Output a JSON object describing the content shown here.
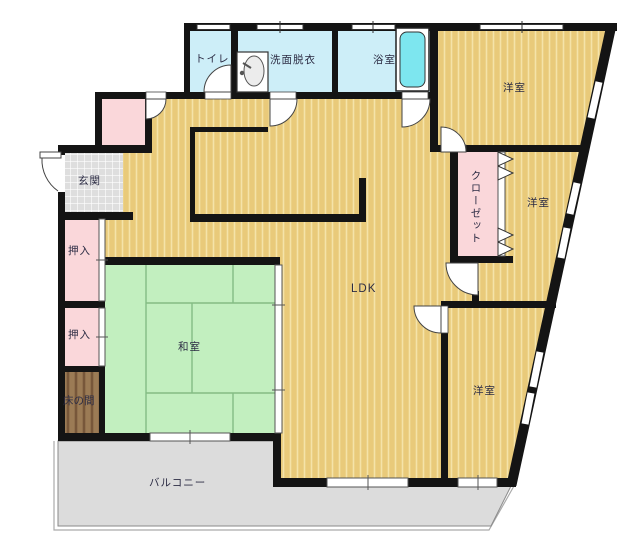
{
  "rooms": [
    {
      "id": "toilet",
      "label": "トイレ"
    },
    {
      "id": "washroom",
      "label": "洗面脱衣"
    },
    {
      "id": "bathroom",
      "label": "浴室"
    },
    {
      "id": "bedroom-1",
      "label": "洋室"
    },
    {
      "id": "closet",
      "label": "クローゼット"
    },
    {
      "id": "bedroom-2",
      "label": "洋室"
    },
    {
      "id": "entrance",
      "label": "玄関"
    },
    {
      "id": "oshiire-1",
      "label": "押入"
    },
    {
      "id": "oshiire-2",
      "label": "押入"
    },
    {
      "id": "tokonoma",
      "label": "床の間"
    },
    {
      "id": "washitsu",
      "label": "和室"
    },
    {
      "id": "ldk",
      "label": "LDK"
    },
    {
      "id": "bedroom-3",
      "label": "洋室"
    },
    {
      "id": "balcony",
      "label": "バルコニー"
    }
  ],
  "colors": {
    "flooring": "#e9ca7a",
    "flooring_stripe": "#f5e3a9",
    "tatami": "#c2efbf",
    "tatami_line": "#84bc84",
    "wet_room": "#cdeef8",
    "bathtub": "#7de6ef",
    "closet_pink": "#fad7da",
    "balcony": "#dcdcdc",
    "entrance_tile": "#dedede",
    "tokonoma_wood": "#9b7b55",
    "wall": "#141414"
  }
}
